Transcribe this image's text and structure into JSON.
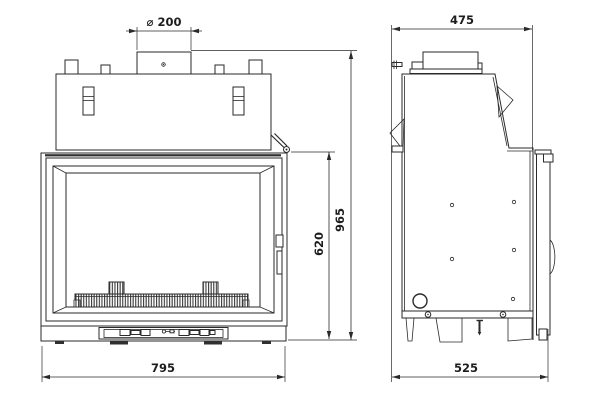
{
  "diagram": {
    "type": "technical-drawing",
    "subject": "fireplace-insert-front-and-side-elevation",
    "background": "#ffffff",
    "line_color": "#2a2a2a",
    "dimensions": {
      "flue_diameter": "⌀ 200",
      "top_depth": "475",
      "overall_height": "965",
      "door_height": "620",
      "overall_width": "795",
      "base_depth": "525"
    }
  }
}
